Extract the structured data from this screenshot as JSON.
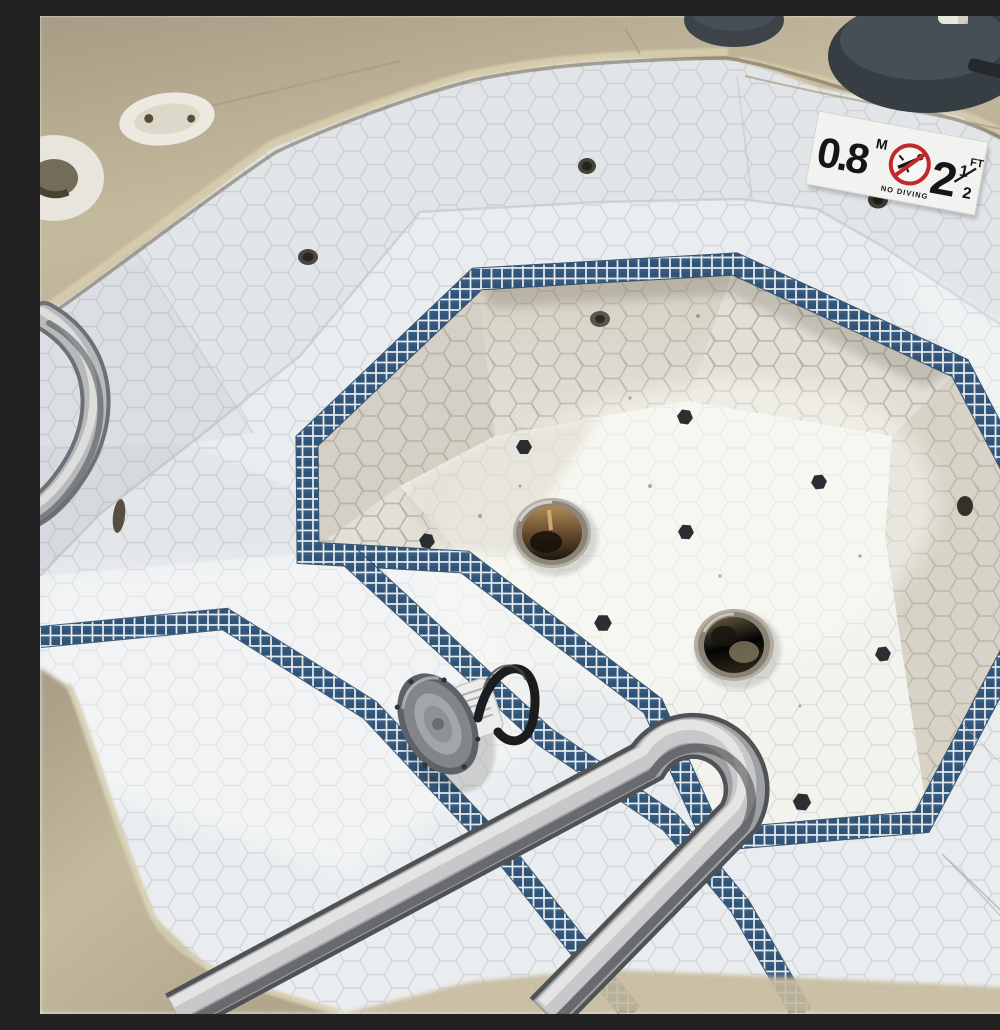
{
  "scene": {
    "type": "photograph",
    "subject": "Empty octagonal spa hot tub with white hexagon mosaic tile, navy blue tile trim bands, two floor drains, a removed pool light fixture with cable, a stainless steel hairpin handrail, tan concrete deck coping, and a depth / no-diving sticker",
    "lighting": "daylight, diagonal sun and shade"
  },
  "depth_sign": {
    "metric_value": "0.8",
    "metric_unit": "M",
    "warning_label": "NO DIVING",
    "imperial_whole": "2",
    "imperial_fraction_numerator": "1",
    "imperial_fraction_denominator": "2",
    "imperial_unit": "FT"
  },
  "palette": {
    "tile_white": "#eef0f2",
    "grout_cool": "#d2d4d9",
    "grout_warm": "#b7b0a5",
    "navy_tile": "#2e5175",
    "band_grout": "#e9edf1",
    "deck_tan": "#c7bb9e",
    "deck_tan_dark": "#a99d82",
    "steel_light": "#ebebe9",
    "steel_mid": "#9fa1a4",
    "steel_dark": "#5a5d60",
    "accent_hex_black": "#1b1e22",
    "drain_rust": "#a97f4a",
    "drain_dark": "#1c1209",
    "sign_red": "#c42727",
    "sign_black": "#111111",
    "sign_white": "#f6f6f4"
  },
  "objects": {
    "drain_count": 2,
    "black_accent_tile_count": 8,
    "handrail": "stainless steel hairpin handrail",
    "light_fixture": "removed pool light with looped cable",
    "post_base_count": 2,
    "deck_fitting_count": 2
  }
}
